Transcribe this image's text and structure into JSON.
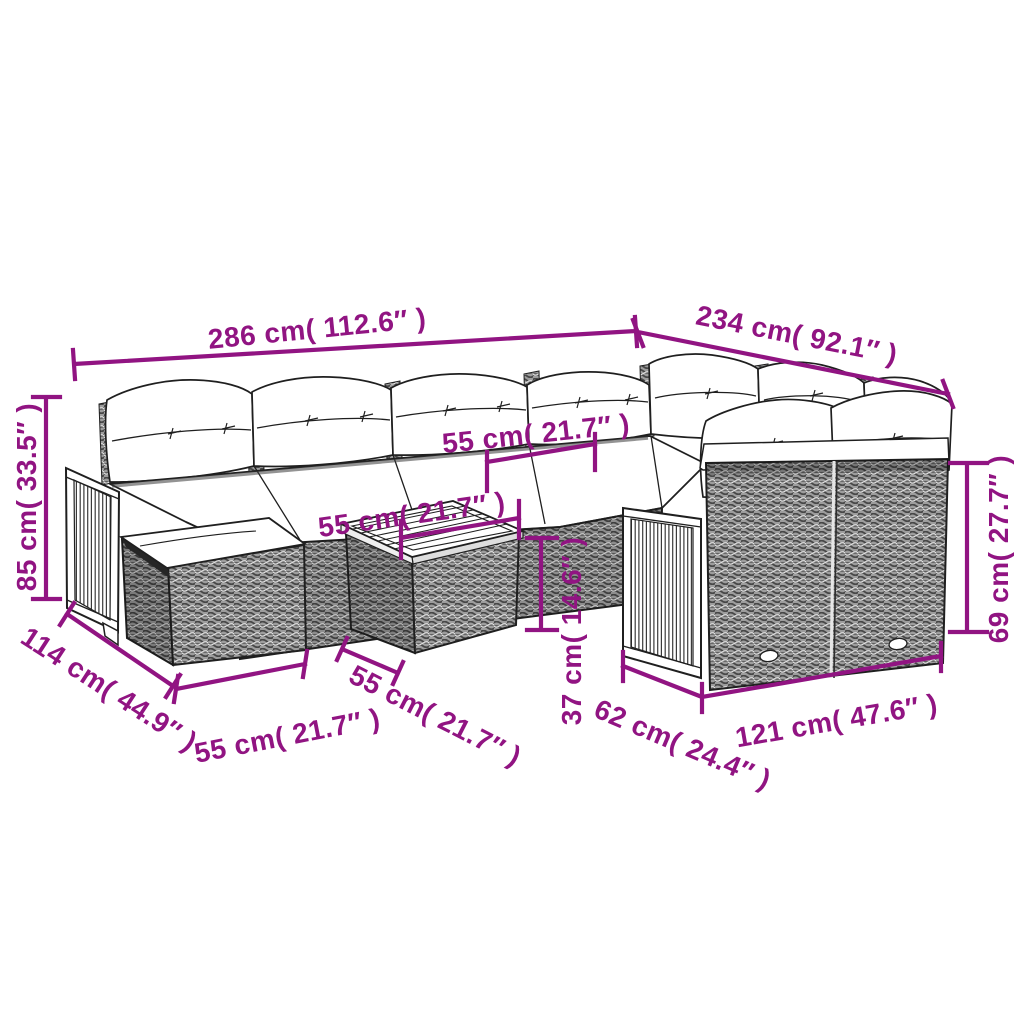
{
  "meta": {
    "image_type": "product dimension diagram",
    "background": "#ffffff"
  },
  "style": {
    "dimension_color": "#911482",
    "outline_color": "#1f1f1f",
    "wicker_gray": "#9d9d9d"
  },
  "product_parts": {
    "sofa_set": "modular-rattan-lounge-set-line-drawing",
    "footstool": "wicker-footstool-with-cushion",
    "coffee_table": "wicker-table-with-wood-slat-top",
    "wood_panels": "acacia-slat-side-panels"
  },
  "dimensions": {
    "back_width": {
      "label": "286 cm( 112.6″ )"
    },
    "right_depth": {
      "label": "234 cm( 92.1″ )"
    },
    "back_height": {
      "label": "85 cm( 33.5″ )"
    },
    "corner_seat_width": {
      "label": "55 cm( 21.7″ )"
    },
    "table_width": {
      "label": "55 cm( 21.7″ )"
    },
    "left_depth": {
      "label": "114 cm( 44.9″ )"
    },
    "footstool_width": {
      "label": "55 cm( 21.7″ )"
    },
    "table_depth": {
      "label": "55 cm( 21.7″ )"
    },
    "table_height": {
      "label": "37 cm( 14.6″ )"
    },
    "front_sofa_depth": {
      "label": "62 cm( 24.4″ )"
    },
    "front_sofa_width": {
      "label": "121 cm( 47.6″ )"
    },
    "front_sofa_height": {
      "label": "69 cm( 27.7″ )"
    }
  }
}
